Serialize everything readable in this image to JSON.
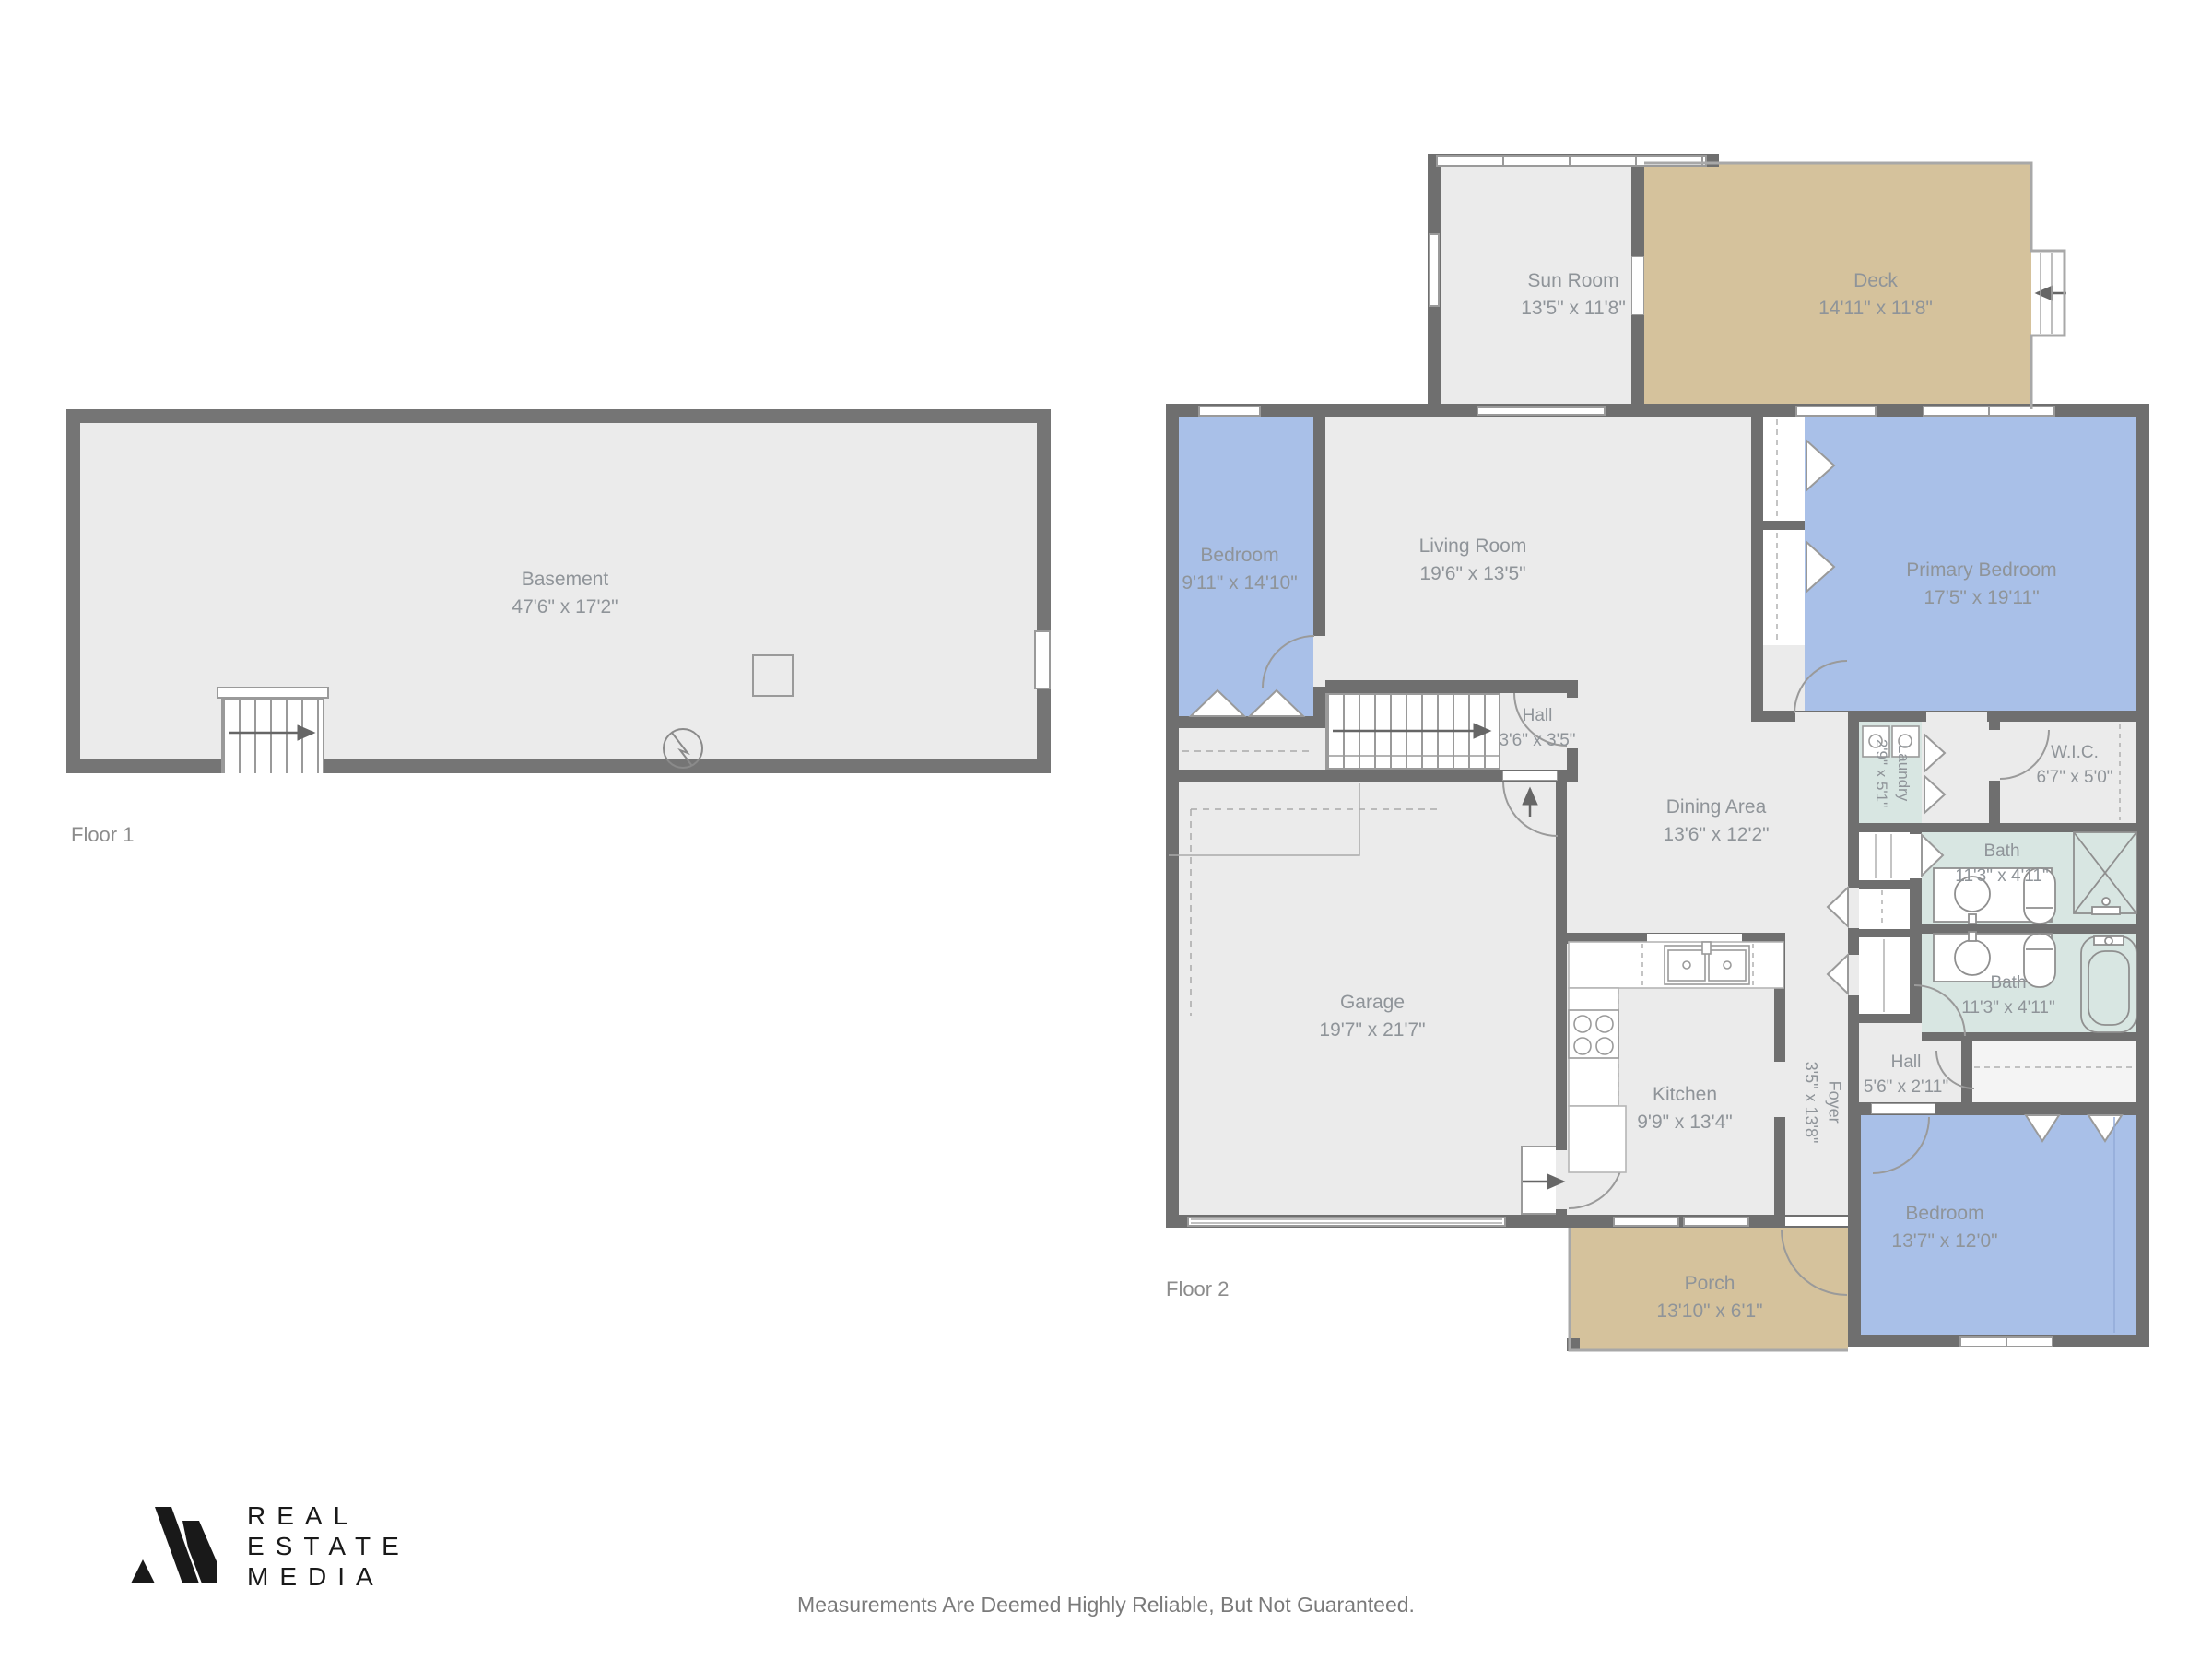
{
  "floors": {
    "floor1_label": "Floor 1",
    "floor2_label": "Floor 2"
  },
  "rooms": {
    "basement": {
      "name": "Basement",
      "dims": "47'6\" x 17'2\""
    },
    "sun_room": {
      "name": "Sun Room",
      "dims": "13'5\" x 11'8\""
    },
    "deck": {
      "name": "Deck",
      "dims": "14'11\" x 11'8\""
    },
    "bedroom_upper": {
      "name": "Bedroom",
      "dims": "9'11\" x 14'10\""
    },
    "living_room": {
      "name": "Living Room",
      "dims": "19'6\" x 13'5\""
    },
    "primary_bedroom": {
      "name": "Primary Bedroom",
      "dims": "17'5\" x 19'11\""
    },
    "hall_upper": {
      "name": "Hall",
      "dims": "3'6\" x 3'5\""
    },
    "dining_area": {
      "name": "Dining Area",
      "dims": "13'6\" x 12'2\""
    },
    "laundry": {
      "name": "Laundry",
      "dims": "2'9\" x 5'1\""
    },
    "wic": {
      "name": "W.I.C.",
      "dims": "6'7\" x 5'0\""
    },
    "bath_a": {
      "name": "Bath",
      "dims": "11'3\" x 4'11\""
    },
    "bath_b": {
      "name": "Bath",
      "dims": "11'3\" x 4'11\""
    },
    "garage": {
      "name": "Garage",
      "dims": "19'7\" x 21'7\""
    },
    "kitchen": {
      "name": "Kitchen",
      "dims": "9'9\" x 13'4\""
    },
    "foyer": {
      "name": "Foyer",
      "dims": "3'5\" x 13'8\""
    },
    "hall_lower": {
      "name": "Hall",
      "dims": "5'6\" x 2'11\""
    },
    "bedroom_lower": {
      "name": "Bedroom",
      "dims": "13'7\" x 12'0\""
    },
    "porch": {
      "name": "Porch",
      "dims": "13'10\" x 6'1\""
    }
  },
  "footer": {
    "logo_line1": "REAL",
    "logo_line2": "ESTATE",
    "logo_line3": "MEDIA",
    "disclaimer": "Measurements Are Deemed Highly Reliable, But Not Guaranteed."
  },
  "colors": {
    "wall": "#6f6f6f",
    "floor": "#ebebeb",
    "bedroom_fill": "#a9c0e8",
    "bath_fill": "#d8e6e2",
    "outdoor_fill": "#d5c29c",
    "fixture_line": "#9a9a9a",
    "label_text": "#8f9499",
    "logo_text": "#191919",
    "disclaimer_text": "#7a7a7a"
  }
}
